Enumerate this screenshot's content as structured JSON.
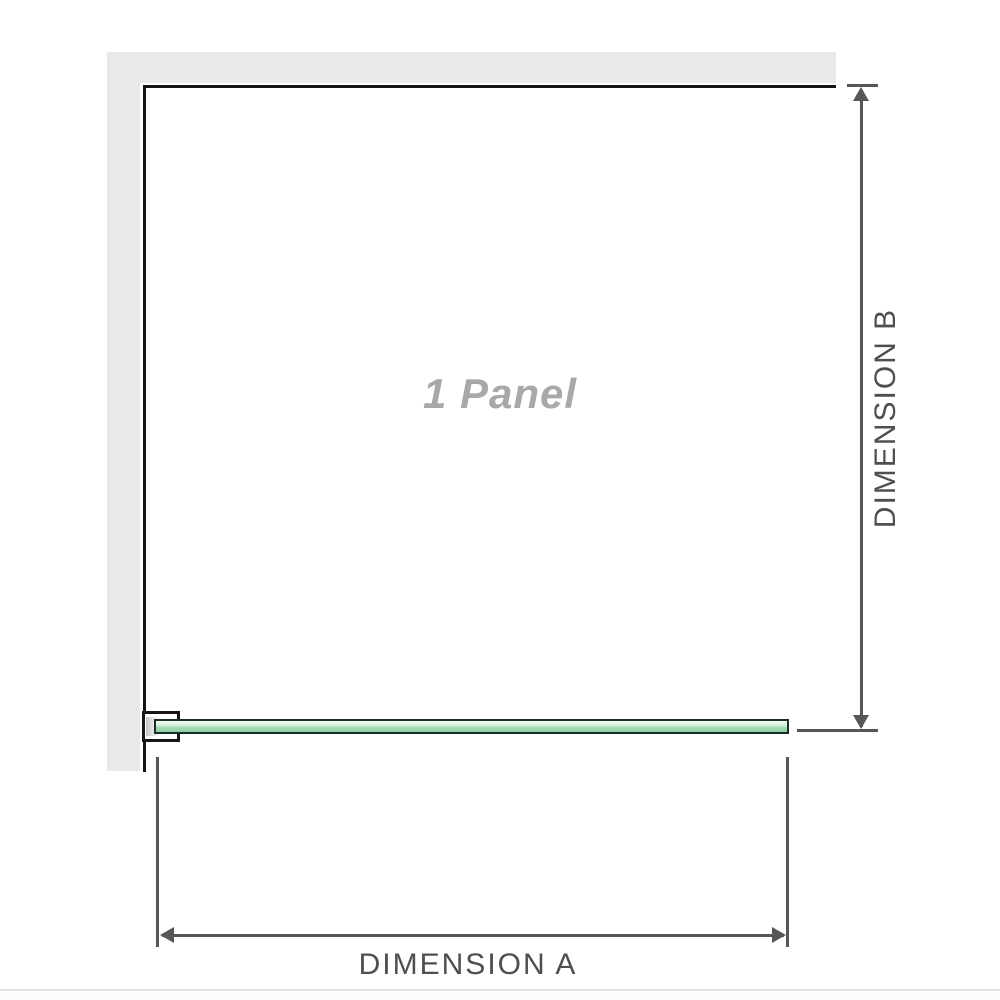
{
  "diagram": {
    "panel_label": "1 Panel",
    "dimension_a": {
      "label": "DIMENSION A"
    },
    "dimension_b": {
      "label": "DIMENSION B"
    }
  },
  "icons": {
    "dimension_b_arrow_up": "triangle-up",
    "dimension_b_arrow_down": "triangle-down",
    "dimension_a_arrow_left": "triangle-left",
    "dimension_a_arrow_right": "triangle-right"
  },
  "colors": {
    "wall": "#e9e9e9",
    "outline": "#161616",
    "glass_border": "#1c2e24",
    "glass_fill_light": "#d9efe1",
    "glass_fill_dark": "#8ed0a4",
    "dimension": "#565656",
    "dimension_text": "#4f4f4f",
    "panel_text": "#a8a8a8",
    "separator": "#e3e3e1"
  }
}
